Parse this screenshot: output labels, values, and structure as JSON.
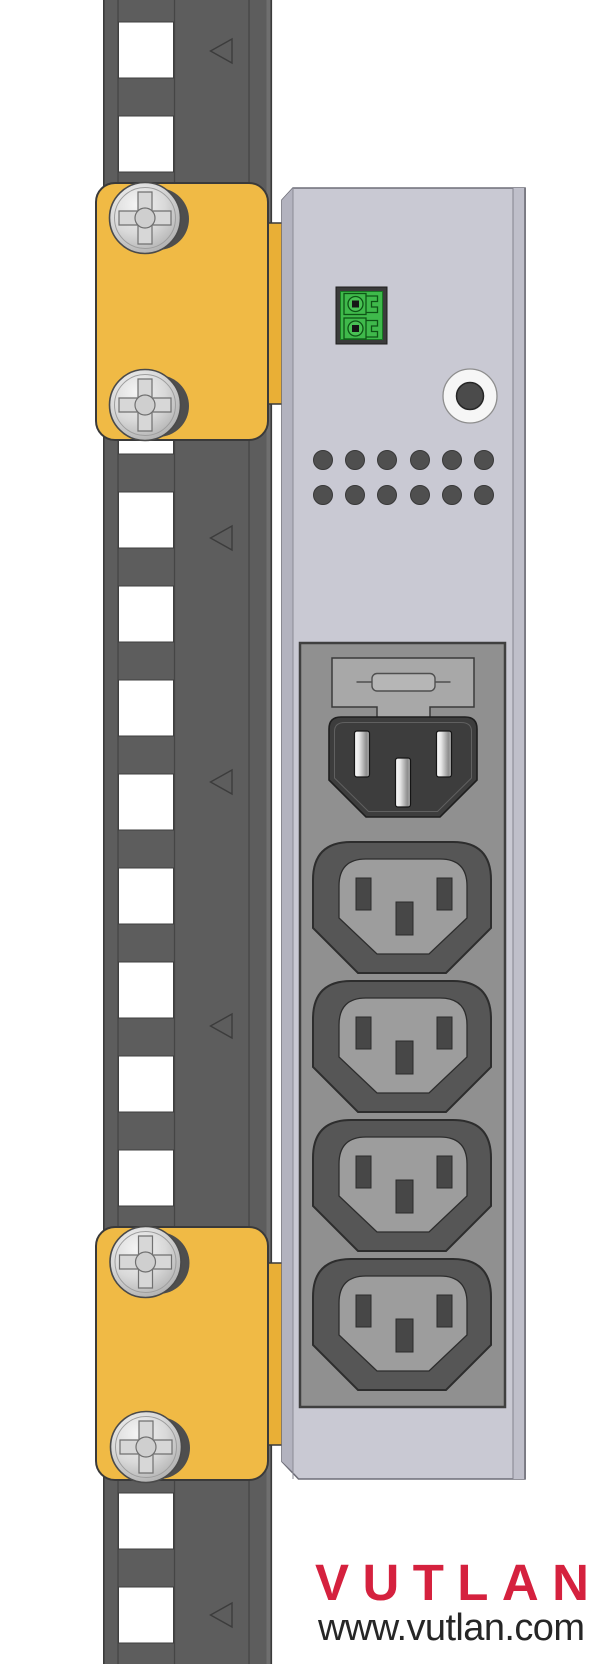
{
  "brand": {
    "logo_text": "VUTLAN",
    "website": "www.vutlan.com",
    "logo_color": "#d5213e",
    "website_color": "#262626"
  },
  "colors": {
    "background": "#ffffff",
    "rail_gray": "#5d5d5d",
    "rail_line": "#454545",
    "hole_white": "#ffffff",
    "bracket_yellow": "#f0ba45",
    "bracket_tab_yellow": "#e9af36",
    "screw_shadow": "#4e4e4e",
    "pdu_body": "#c9c9d3",
    "pdu_left_bevel": "#b3b3bf",
    "pdu_right_strip": "#bfbfca",
    "module_panel": "#909090",
    "outlet_outer": "#565656",
    "outlet_recess": "#9d9d9d",
    "outlet_slot": "#474747",
    "inlet_body": "#3d3d3d",
    "fuse_holder": "#a8a8a8",
    "terminal_green": "#3fb94b",
    "terminal_frame": "#3b3b3b",
    "jack_ring": "#f6f6f6",
    "jack_hole": "#4b4b4b",
    "vent_hole": "#4f4f4f"
  },
  "parts": {
    "rack_rail": {
      "name": "rack mounting rail",
      "visible_square_holes": 13,
      "direction_arrows": 5
    },
    "brackets": {
      "name": "mounting bracket",
      "count": 2,
      "screws_per_bracket": 2
    },
    "terminal_block": {
      "name": "2-pin terminal block",
      "positions": 2
    },
    "jack": {
      "name": "round jack socket",
      "count": 1
    },
    "vents": {
      "name": "ventilation holes",
      "rows": 2,
      "columns": 6
    },
    "fuse": {
      "name": "fuse drawer",
      "count": 1
    },
    "inlet": {
      "name": "IEC C14 power inlet",
      "pins": 3
    },
    "outlets": {
      "name": "IEC C13 outlet",
      "count": 4,
      "slots_per_outlet": 3
    }
  }
}
